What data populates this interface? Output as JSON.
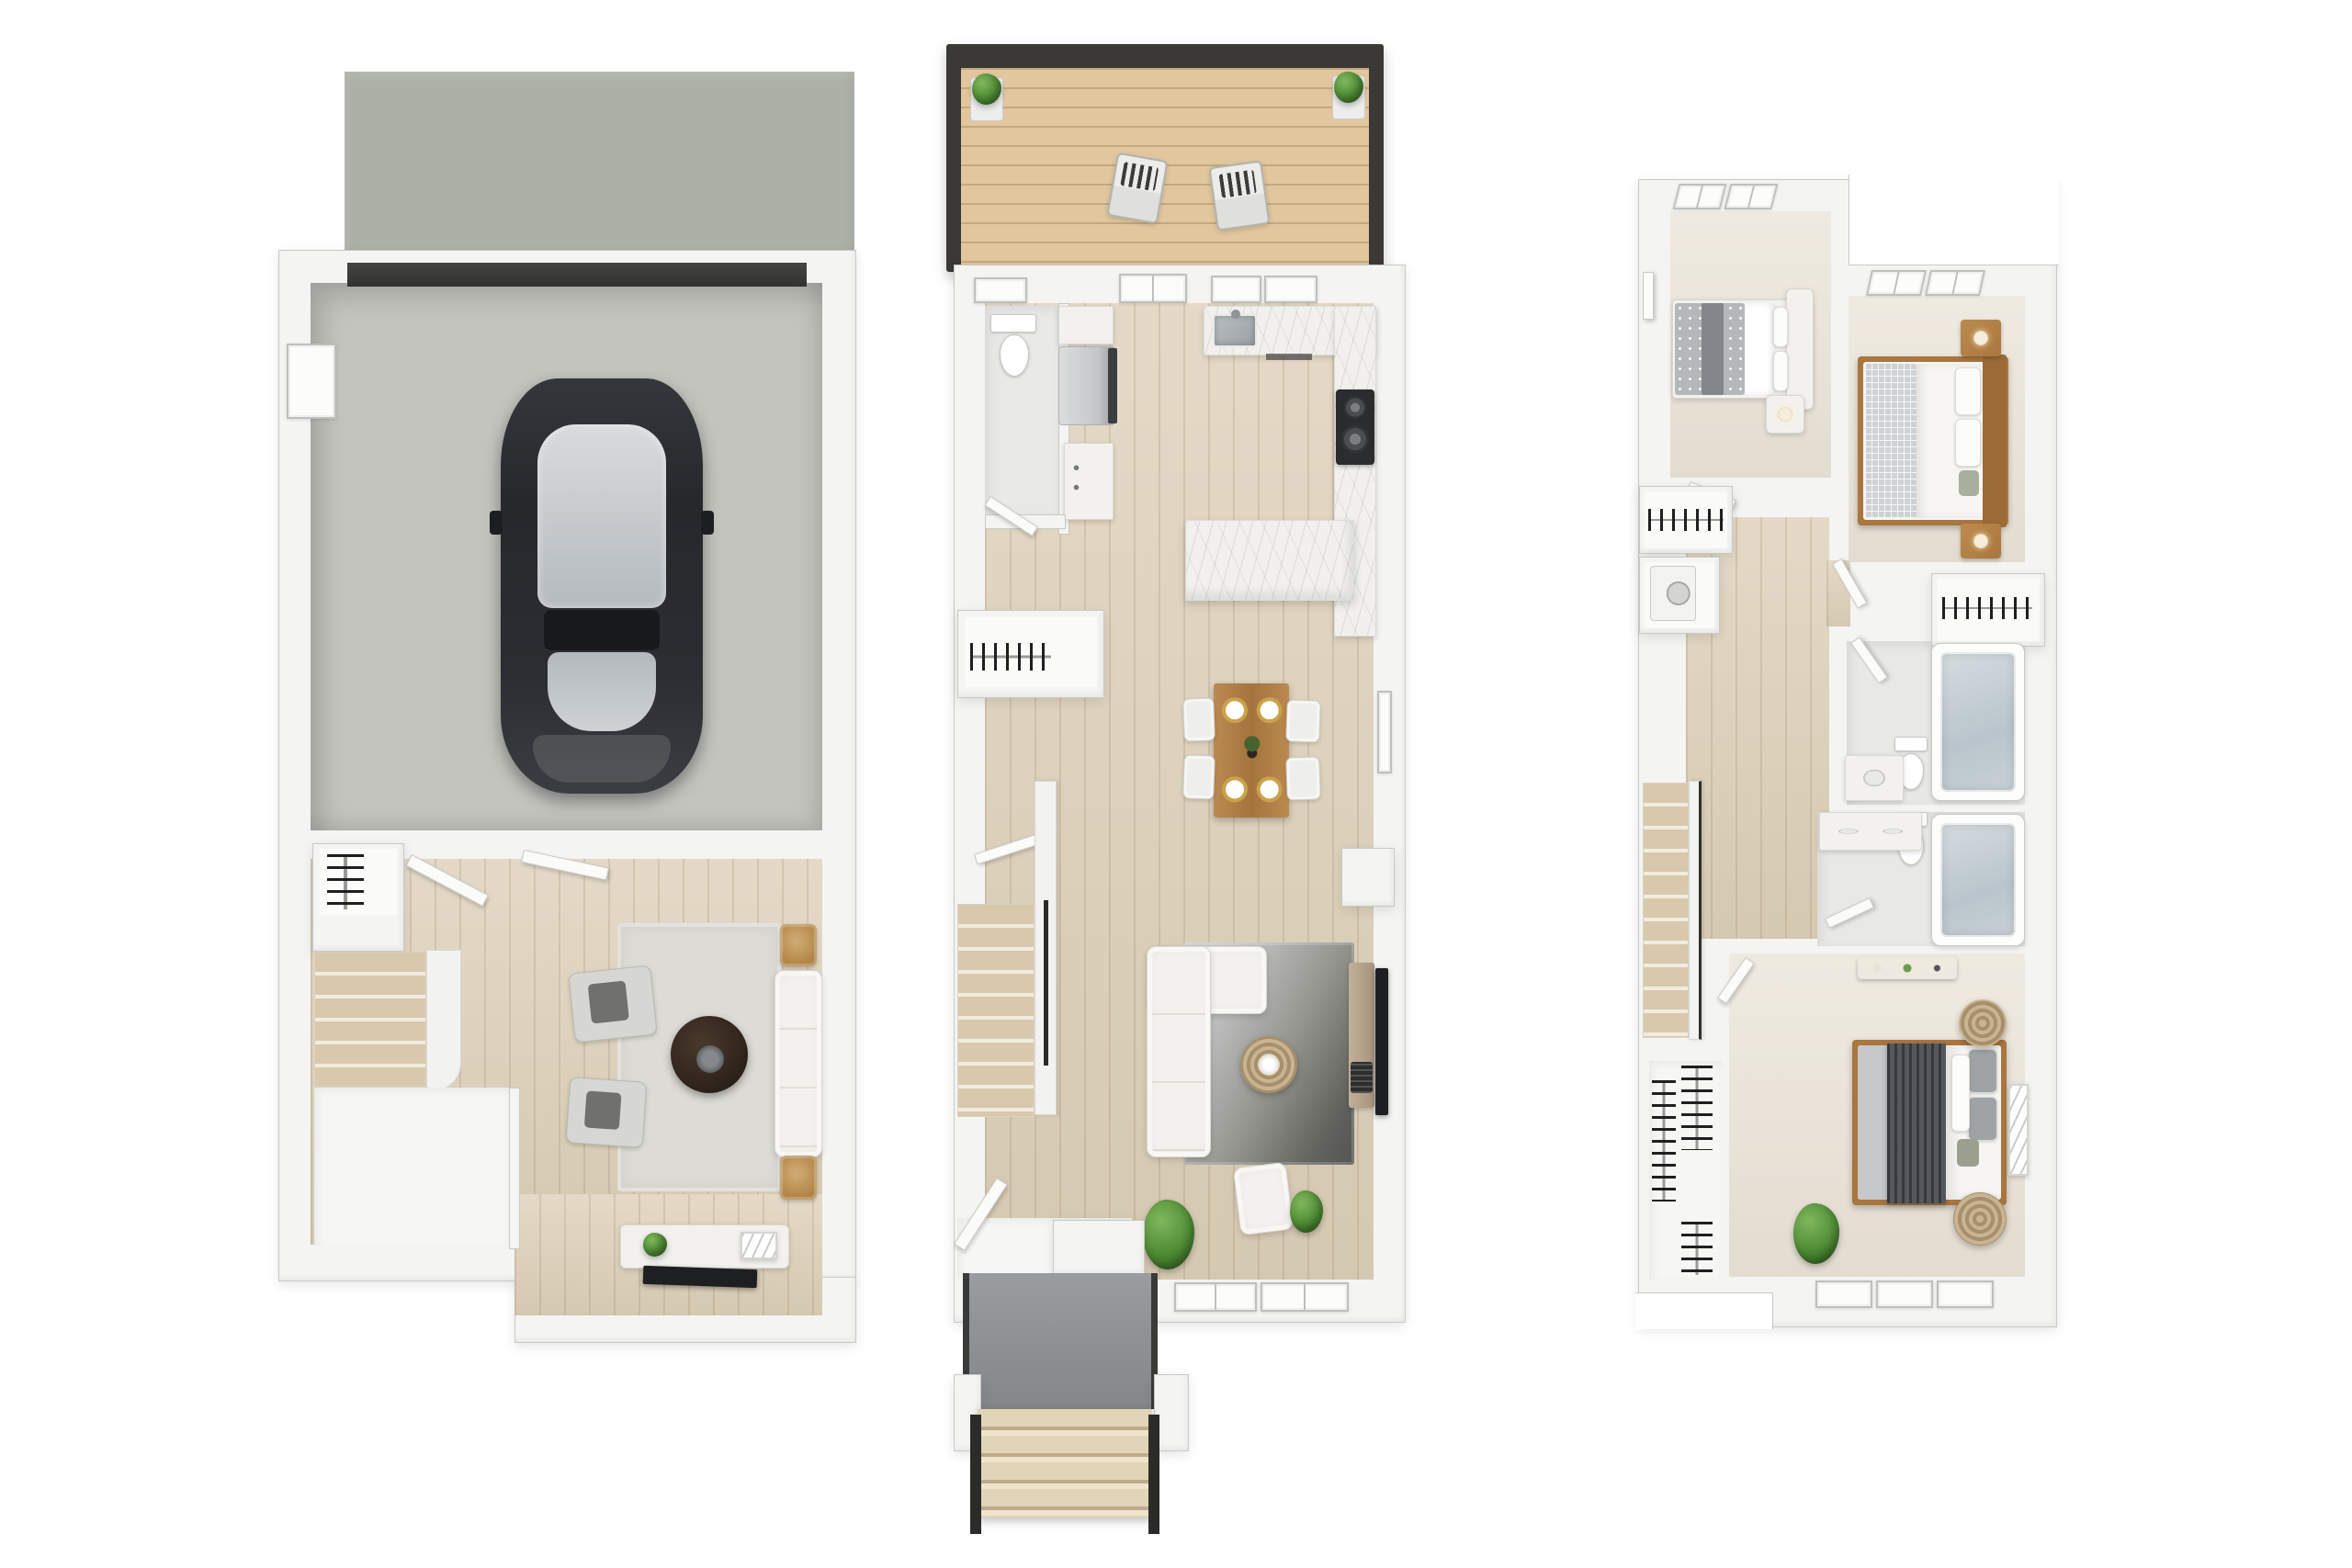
{
  "palette": {
    "wall_face": "#f4f4f2",
    "wall_edge": "#c9c9c6",
    "driveway": "#adb0a6",
    "garage_floor": "#c3c4be",
    "wood_floor": "#dccfb7",
    "step_wood": "#d8c9ad",
    "deck_wood": "#e2c79e",
    "deck_frame": "#3a3936",
    "carpet": "#eae3d7",
    "tile": "#e8e8e6",
    "plant_green": "#4f8d35",
    "car_body": "#26282c",
    "marble": "#f1f0ec",
    "dining_wood": "#b98a52",
    "walkway": "#8f9294",
    "rail_dark": "#2b2b29",
    "hanger": "#1f1f1f",
    "sofa_white": "#f2f1ed",
    "rug_light": "#d0d0cb",
    "rug_dark": "#545551",
    "bed_wood": "#a9763f",
    "drape": "#55585c",
    "tub_glass": "#b9c5cc",
    "gold": "#caa24a"
  },
  "scene": {
    "type": "3d-floorplan-rendering",
    "view": "top-down",
    "units": [
      {
        "name": "ground-floor",
        "position": "left",
        "spaces": [
          {
            "name": "driveway",
            "items": []
          },
          {
            "name": "garage",
            "items": [
              "car",
              "garage-door-opening",
              "window"
            ]
          },
          {
            "name": "recreation-room",
            "items": [
              "staircase",
              "closet-hangers",
              "armchair",
              "armchair",
              "round-coffee-table",
              "sofa",
              "end-table",
              "end-table",
              "area-rug",
              "tv-console",
              "tv"
            ]
          },
          {
            "name": "entry-nook",
            "items": []
          }
        ]
      },
      {
        "name": "main-floor",
        "position": "center",
        "spaces": [
          {
            "name": "deck",
            "items": [
              "planter",
              "planter",
              "lounge-chair",
              "lounge-chair"
            ]
          },
          {
            "name": "powder-room",
            "items": [
              "toilet",
              "vanity-sink",
              "window",
              "door"
            ]
          },
          {
            "name": "kitchen",
            "items": [
              "sink",
              "dishwasher",
              "cooktop",
              "refrigerator",
              "pantry-cabinet",
              "island"
            ]
          },
          {
            "name": "coat-closet",
            "items": [
              "hangers"
            ]
          },
          {
            "name": "dining-area",
            "items": [
              "dining-table",
              "dining-chair",
              "dining-chair",
              "dining-chair",
              "dining-chair",
              "place-settings",
              "centerpiece"
            ]
          },
          {
            "name": "living-room",
            "items": [
              "sectional-sofa",
              "area-rug",
              "round-coffee-table",
              "tv-console",
              "tv",
              "speaker",
              "armchair",
              "plant",
              "plant",
              "windows"
            ]
          },
          {
            "name": "staircase",
            "items": [
              "banister"
            ]
          },
          {
            "name": "entry",
            "items": [
              "front-door",
              "walkway",
              "exterior-steps",
              "railings"
            ]
          }
        ]
      },
      {
        "name": "upper-floor",
        "position": "right",
        "spaces": [
          {
            "name": "bedroom-2",
            "items": [
              "bed",
              "headboard",
              "nightstand",
              "skylight-windows",
              "door"
            ]
          },
          {
            "name": "bedroom-3",
            "items": [
              "bed",
              "wood-headboard",
              "nightstand",
              "nightstand",
              "windows",
              "door"
            ]
          },
          {
            "name": "hall-closet",
            "items": [
              "hangers"
            ]
          },
          {
            "name": "laundry-closet",
            "items": [
              "washer"
            ]
          },
          {
            "name": "linen-closet",
            "items": [
              "hangers"
            ]
          },
          {
            "name": "bathroom",
            "items": [
              "bathtub",
              "toilet",
              "vanity-sink",
              "door"
            ]
          },
          {
            "name": "ensuite-bathroom",
            "items": [
              "bathtub",
              "toilet",
              "double-vanity",
              "door"
            ]
          },
          {
            "name": "primary-bedroom",
            "items": [
              "bed",
              "dresser",
              "side-table",
              "side-table",
              "artwork",
              "plant",
              "windows"
            ]
          },
          {
            "name": "walk-in-closet",
            "items": [
              "hangers"
            ]
          },
          {
            "name": "hallway",
            "items": [
              "staircase",
              "banister"
            ]
          }
        ]
      }
    ]
  }
}
